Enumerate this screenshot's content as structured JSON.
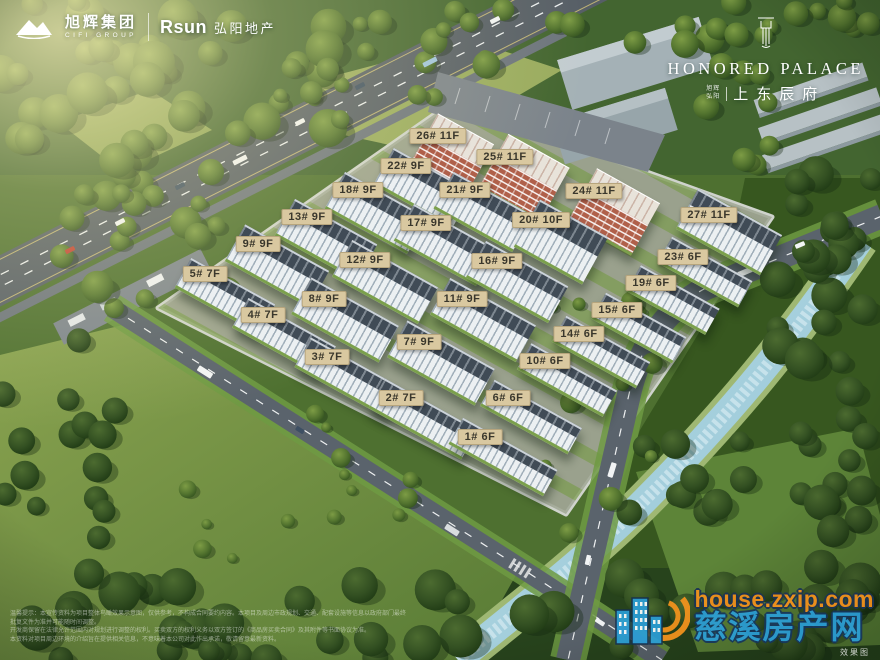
{
  "colors": {
    "label_bg": "#d9c8a0",
    "label_text": "#3a372c",
    "watermark_orange": "#f7941d",
    "watermark_blue": "#2b9fd8",
    "brick": "#b0604a"
  },
  "brand": {
    "cifi": {
      "name_cn": "旭辉集团",
      "name_en": "CIFI GROUP"
    },
    "rsun": {
      "logo": "Rsun",
      "name_cn": "弘阳地产"
    },
    "project": {
      "name_en": "HONORED PALACE",
      "dev1": "旭辉",
      "dev2": "弘阳",
      "name_cn": "上东辰府"
    }
  },
  "watermark": {
    "url": "house.zxip.com",
    "site_name": "慈溪房产网",
    "note": "效果图"
  },
  "disclaimer_lines": [
    "温馨提示：本宣传资料为项目整体鸟瞰效果示意图，仅供参考，不构成合同要约内容。本项目及周边市政规划、交通、配套设施等信息以政府部门最终批复文件为准并可能随时间调整。",
    "开发商保留在法律允许范围内对规划进行调整的权利。买卖双方的权利义务以双方签订的《商品房买卖合同》及其附件等书面协议为准。",
    "本资料对项目周边环境的介绍旨在提供相关信息，不意味着本公司对此作出承诺，敬请留意最新资料。"
  ],
  "buildings": [
    {
      "label": "1# 6F",
      "lx": 480,
      "ly": 437,
      "bx": 503,
      "by": 457,
      "w": 108,
      "h": 30,
      "style": "white"
    },
    {
      "label": "2# 7F",
      "lx": 401,
      "ly": 398,
      "bx": 423,
      "by": 419,
      "w": 106,
      "h": 34,
      "style": "white"
    },
    {
      "label": "3# 7F",
      "lx": 327,
      "ly": 357,
      "bx": 349,
      "by": 378,
      "w": 106,
      "h": 34,
      "style": "white"
    },
    {
      "label": "4# 7F",
      "lx": 263,
      "ly": 315,
      "bx": 284,
      "by": 337,
      "w": 100,
      "h": 34,
      "style": "white"
    },
    {
      "label": "5# 7F",
      "lx": 205,
      "ly": 274,
      "bx": 225,
      "by": 296,
      "w": 96,
      "h": 34,
      "style": "white"
    },
    {
      "label": "6# 6F",
      "lx": 508,
      "ly": 398,
      "bx": 531,
      "by": 417,
      "w": 100,
      "h": 30,
      "style": "white"
    },
    {
      "label": "7# 9F",
      "lx": 419,
      "ly": 342,
      "bx": 441,
      "by": 363,
      "w": 100,
      "h": 42,
      "style": "white"
    },
    {
      "label": "8# 9F",
      "lx": 324,
      "ly": 299,
      "bx": 345,
      "by": 320,
      "w": 100,
      "h": 42,
      "style": "white"
    },
    {
      "label": "9# 9F",
      "lx": 258,
      "ly": 244,
      "bx": 277,
      "by": 266,
      "w": 96,
      "h": 42,
      "style": "white"
    },
    {
      "label": "10# 6F",
      "lx": 545,
      "ly": 361,
      "bx": 567,
      "by": 380,
      "w": 98,
      "h": 30,
      "style": "white"
    },
    {
      "label": "11# 9F",
      "lx": 462,
      "ly": 299,
      "bx": 483,
      "by": 320,
      "w": 98,
      "h": 42,
      "style": "white"
    },
    {
      "label": "12# 9F",
      "lx": 365,
      "ly": 260,
      "bx": 385,
      "by": 282,
      "w": 98,
      "h": 42,
      "style": "white"
    },
    {
      "label": "13# 9F",
      "lx": 307,
      "ly": 217,
      "bx": 326,
      "by": 240,
      "w": 94,
      "h": 42,
      "style": "white"
    },
    {
      "label": "14# 6F",
      "lx": 579,
      "ly": 334,
      "bx": 601,
      "by": 352,
      "w": 96,
      "h": 30,
      "style": "white"
    },
    {
      "label": "15# 6F",
      "lx": 617,
      "ly": 310,
      "bx": 639,
      "by": 328,
      "w": 92,
      "h": 30,
      "style": "white"
    },
    {
      "label": "16# 9F",
      "lx": 497,
      "ly": 261,
      "bx": 517,
      "by": 282,
      "w": 94,
      "h": 42,
      "style": "white"
    },
    {
      "label": "17# 9F",
      "lx": 426,
      "ly": 223,
      "bx": 445,
      "by": 245,
      "w": 94,
      "h": 42,
      "style": "white"
    },
    {
      "label": "18# 9F",
      "lx": 358,
      "ly": 190,
      "bx": 376,
      "by": 213,
      "w": 94,
      "h": 42,
      "style": "white"
    },
    {
      "label": "19# 6F",
      "lx": 651,
      "ly": 283,
      "bx": 673,
      "by": 300,
      "w": 90,
      "h": 30,
      "style": "white"
    },
    {
      "label": "20# 10F",
      "lx": 541,
      "ly": 220,
      "bx": 561,
      "by": 242,
      "w": 78,
      "h": 54,
      "style": "white"
    },
    {
      "label": "21# 9F",
      "lx": 465,
      "ly": 190,
      "bx": 483,
      "by": 212,
      "w": 90,
      "h": 42,
      "style": "white"
    },
    {
      "label": "22# 9F",
      "lx": 406,
      "ly": 166,
      "bx": 423,
      "by": 188,
      "w": 90,
      "h": 42,
      "style": "white"
    },
    {
      "label": "23# 6F",
      "lx": 683,
      "ly": 257,
      "bx": 705,
      "by": 272,
      "w": 92,
      "h": 30,
      "style": "white"
    },
    {
      "label": "24# 11F",
      "lx": 594,
      "ly": 191,
      "bx": 614,
      "by": 212,
      "w": 72,
      "h": 60,
      "style": "brick"
    },
    {
      "label": "25# 11F",
      "lx": 505,
      "ly": 157,
      "bx": 524,
      "by": 178,
      "w": 70,
      "h": 62,
      "style": "brick"
    },
    {
      "label": "26# 11F",
      "lx": 438,
      "ly": 136,
      "bx": 451,
      "by": 156,
      "w": 64,
      "h": 62,
      "style": "brick"
    },
    {
      "label": "27# 11F",
      "lx": 709,
      "ly": 215,
      "bx": 729,
      "by": 232,
      "w": 96,
      "h": 46,
      "style": "white"
    }
  ]
}
